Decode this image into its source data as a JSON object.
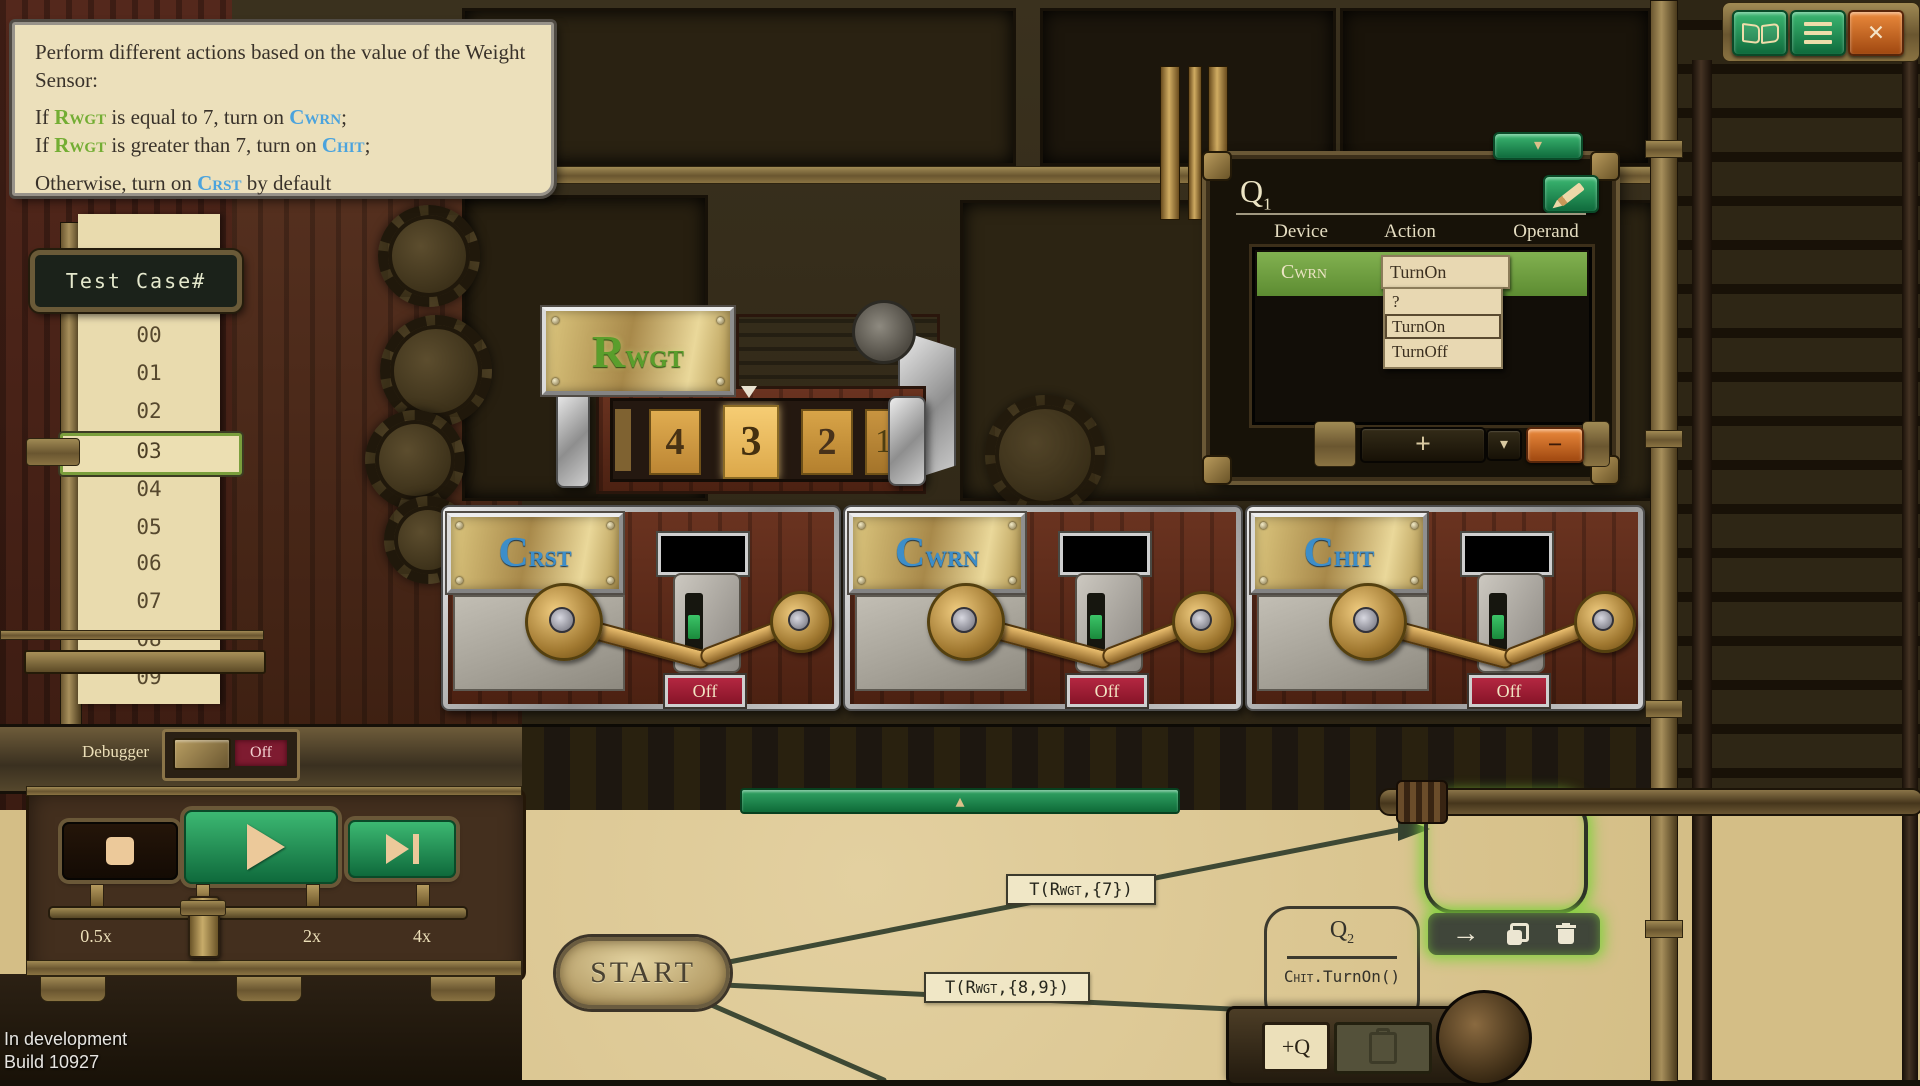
{
  "header_bar": {
    "close_glyph": "×"
  },
  "instructions": {
    "intro": "Perform different actions based on the value of the Weight Sensor:",
    "lines": [
      {
        "pre": "If ",
        "sensor": "Rwgt",
        "mid": " is equal to 7, turn on ",
        "device": "Cwrn",
        "post": ";"
      },
      {
        "pre": "If ",
        "sensor": "Rwgt",
        "mid": " is greater than 7, turn on ",
        "device": "Chit",
        "post": ";"
      },
      {
        "pre": "Otherwise, turn on ",
        "device": "Crst",
        "post": " by default"
      }
    ]
  },
  "test_cases": {
    "header": "Test Case#",
    "items": [
      "00",
      "01",
      "02",
      "03",
      "04",
      "05",
      "06",
      "07",
      "08",
      "09"
    ],
    "selected": "03"
  },
  "sensor": {
    "name_main": "R",
    "name_sub": "WGT",
    "reel_values": [
      "4",
      "3",
      "2"
    ],
    "reel_next_partial": "1",
    "current_value": "3"
  },
  "devices": [
    {
      "name_main": "C",
      "name_sub": "RST",
      "status": "Off"
    },
    {
      "name_main": "C",
      "name_sub": "WRN",
      "status": "Off"
    },
    {
      "name_main": "C",
      "name_sub": "HIT",
      "status": "Off"
    }
  ],
  "q1_panel": {
    "title_main": "Q",
    "title_sub": "1",
    "columns": [
      "Device",
      "Action",
      "Operand"
    ],
    "row": {
      "device": "Cwrn",
      "action": "TurnOn"
    },
    "dropdown": {
      "options": [
        "?",
        "TurnOn",
        "TurnOff"
      ],
      "selected": "TurnOn"
    }
  },
  "controls": {
    "debugger_label": "Debugger",
    "debugger_state": "Off",
    "speeds": [
      "0.5x",
      "1x",
      "2x",
      "4x"
    ],
    "current_speed": "1x"
  },
  "graph": {
    "start_label": "START",
    "edges": [
      {
        "pre": "T(",
        "sensor": "Rwgt",
        "post": ",{7})"
      },
      {
        "pre": "T(",
        "sensor": "Rwgt",
        "post": ",{8,9})"
      }
    ],
    "q2": {
      "title_main": "Q",
      "title_sub": "2",
      "body_device": "Chit",
      "body_post": ".TurnOn()"
    },
    "add_q_label": "+Q"
  },
  "footer": {
    "line1": "In development",
    "line2": "Build 10927"
  },
  "icons": {
    "plus": "+",
    "minus": "−",
    "chevron_down": "▾",
    "triangle_up": "▴",
    "triangle_down": "▾",
    "arrow_right": "→"
  },
  "colors": {
    "sensor_green": "#73ad33",
    "device_blue": "#4ba3dd",
    "selection_glow": "#7fd13b",
    "row_green": "#6fa33c",
    "off_red": "#9c1c33",
    "parchment": "#d8c28c"
  }
}
